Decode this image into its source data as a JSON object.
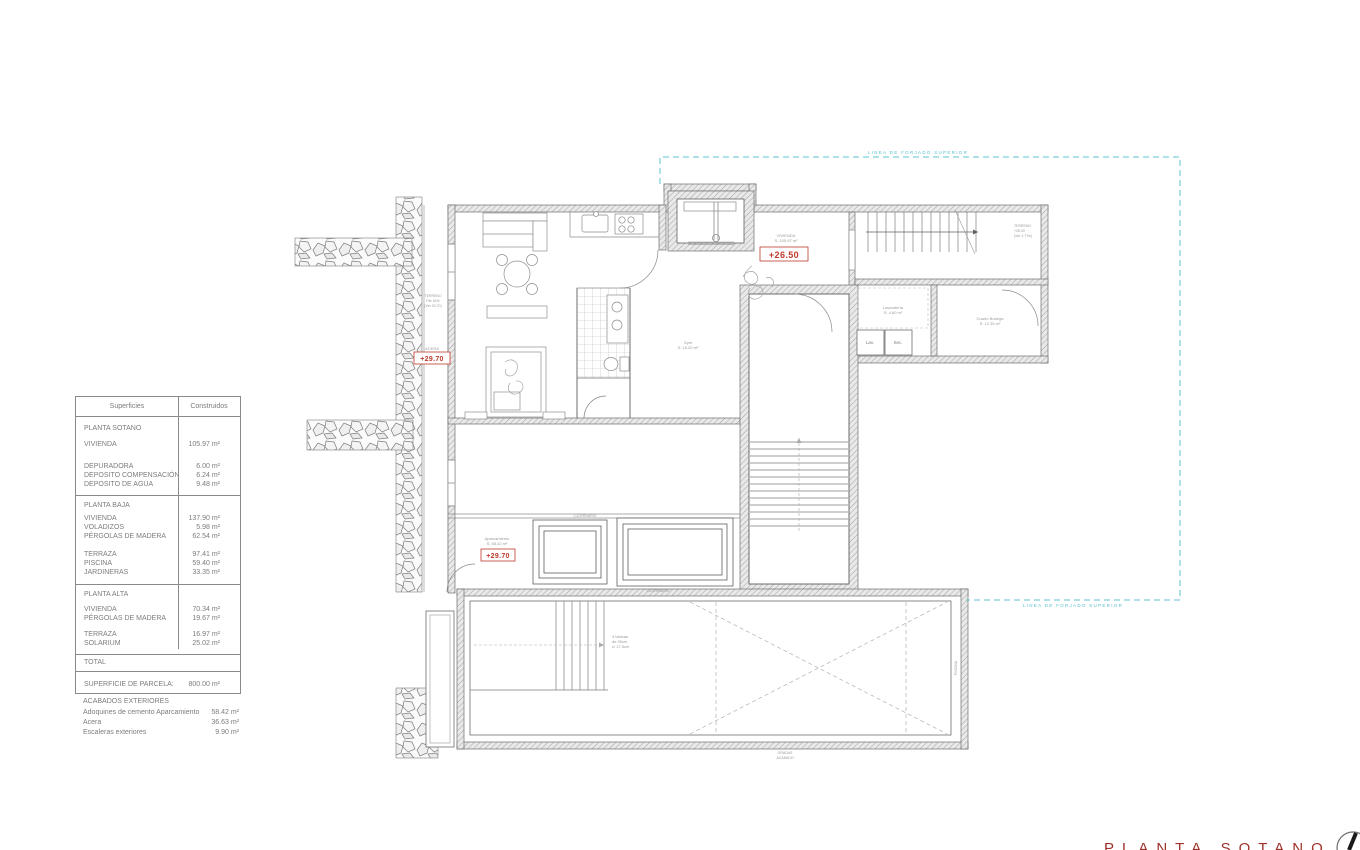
{
  "title_block": {
    "title": "PLANTA SOTANO"
  },
  "areas_table": {
    "col_superficies": "Superficies",
    "col_construidos": "Construidos",
    "sotano_title": "PLANTA SOTANO",
    "sotano_rows": [
      {
        "label": "VIVIENDA",
        "value": "105.97 m²"
      },
      {
        "label": "DEPURADORA",
        "value": "6.00 m²"
      },
      {
        "label": "DEPOSITO COMPENSACIÓN",
        "value": "6.24 m²"
      },
      {
        "label": "DEPOSITO DE AGUA",
        "value": "9.48 m²"
      }
    ],
    "baja_title": "PLANTA BAJA",
    "baja_rows": [
      {
        "label": "VIVIENDA",
        "value": "137.90 m²"
      },
      {
        "label": "VOLADIZOS",
        "value": "5.98 m²"
      },
      {
        "label": "PÉRGOLAS DE MADERA",
        "value": "62.54 m²"
      },
      {
        "label": "TERRAZA",
        "value": "97.41 m²"
      },
      {
        "label": "PISCINA",
        "value": "59.40 m²"
      },
      {
        "label": "JARDINERAS",
        "value": "33.35 m²"
      }
    ],
    "alta_title": "PLANTA ALTA",
    "alta_rows": [
      {
        "label": "VIVIENDA",
        "value": "70.34 m²"
      },
      {
        "label": "PÉRGOLAS DE MADERA",
        "value": "19.67 m²"
      },
      {
        "label": "TERRAZA",
        "value": "16.97 m²"
      },
      {
        "label": "SOLARIUM",
        "value": "25.02 m²"
      }
    ],
    "total_label": "TOTAL",
    "parcela_label": "SUPERFICIE DE PARCELA:",
    "parcela_value": "800.00 m²"
  },
  "exteriores": {
    "title": "ACABADOS EXTERIORES",
    "rows": [
      {
        "label": "Adoquines de cemento Aparcamiento",
        "value": "58.42 m²"
      },
      {
        "label": "Acera",
        "value": "36.63 m²"
      },
      {
        "label": "Escaleras exteriores",
        "value": "9.90 m²"
      }
    ]
  },
  "plan": {
    "level_hall": "+26.50",
    "level_acera": "+29.70",
    "level_aparcamiento": "+29.70",
    "hall_note_1": "VIVIENDA",
    "hall_note_2": "S: 105.97 m²",
    "acera_note": "ACERA",
    "aparcamiento_note_1": "Aparcamiento",
    "aparcamiento_note_2": "S: 58.42 m²",
    "gym_note_1": "Gym",
    "gym_note_2": "S: 15.20 m²",
    "laundry_note_1": "Lavandería",
    "laundry_note_2": "S: 4.60 m²",
    "laundry_cell_1": "Lav.",
    "laundry_cell_2": "Sec.",
    "storage_note_1": "Cuarto Bodega",
    "storage_note_2": "S: 12.35 m²",
    "terreno_right_1": "TERRENO",
    "terreno_right_2": "+28.00",
    "terreno_right_3": "(Ver 1.77m)",
    "terreno_left_1": "TERRENO",
    "terreno_left_2": "Pte 16%",
    "terreno_left_3": "(Ver 29.70)",
    "stair_note_1": "4 tabicas",
    "stair_note_2": "de 30cm",
    "stair_note_3": "c/ 17.5cm",
    "skylight_note_1": "LUCERNARIO",
    "skylight_note_2": "LUCERNARIO",
    "pool_note_1": "GRADAS",
    "pool_note_2": "ACABADO",
    "pool_side_note": "PISCINA",
    "slab_line_top": "LINEA DE FORJADO SUPERIOR",
    "slab_line_bottom": "LINEA DE FORJADO SUPERIOR"
  },
  "colors": {
    "accent_red": "#c0392b",
    "title_red": "#9e3028",
    "slab_cyan": "#5ec6cf"
  }
}
